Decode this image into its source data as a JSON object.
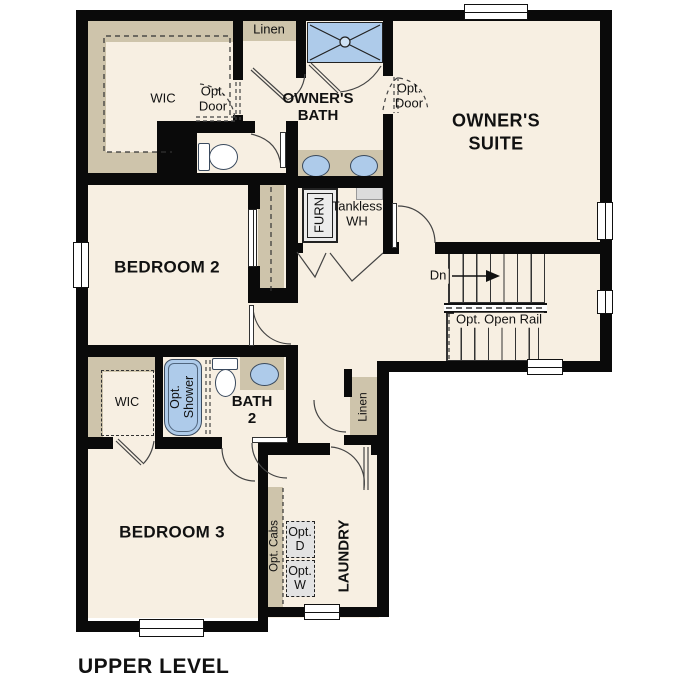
{
  "title": "UPPER LEVEL",
  "colors": {
    "floor": "#f7efe2",
    "wall": "#0a0a0a",
    "shelving_tan": "#cec4ab",
    "fixture_blue": "#aecbea",
    "appliance_gray": "#e3e3e3"
  },
  "labels": {
    "wic_upper": "WIC",
    "opt_door_wic": "Opt.\nDoor",
    "linen_upper": "Linen",
    "owners_bath": "OWNER'S\nBATH",
    "opt_door_suite": "Opt.\nDoor",
    "owners_suite": "OWNER'S\nSUITE",
    "bedroom2": "BEDROOM 2",
    "furnace": "FURN",
    "tankless_wh": "Tankless\nWH",
    "stairs_down": "Dn",
    "opt_open_rail": "Opt. Open Rail",
    "wic_lower": "WIC",
    "opt_shower": "Opt.\nShower",
    "bath2": "BATH\n2",
    "linen_lower": "Linen",
    "bedroom3": "BEDROOM 3",
    "opt_cabs": "Opt. Cabs",
    "opt_dryer": "Opt.\nD",
    "opt_washer": "Opt.\nW",
    "laundry": "LAUNDRY"
  }
}
